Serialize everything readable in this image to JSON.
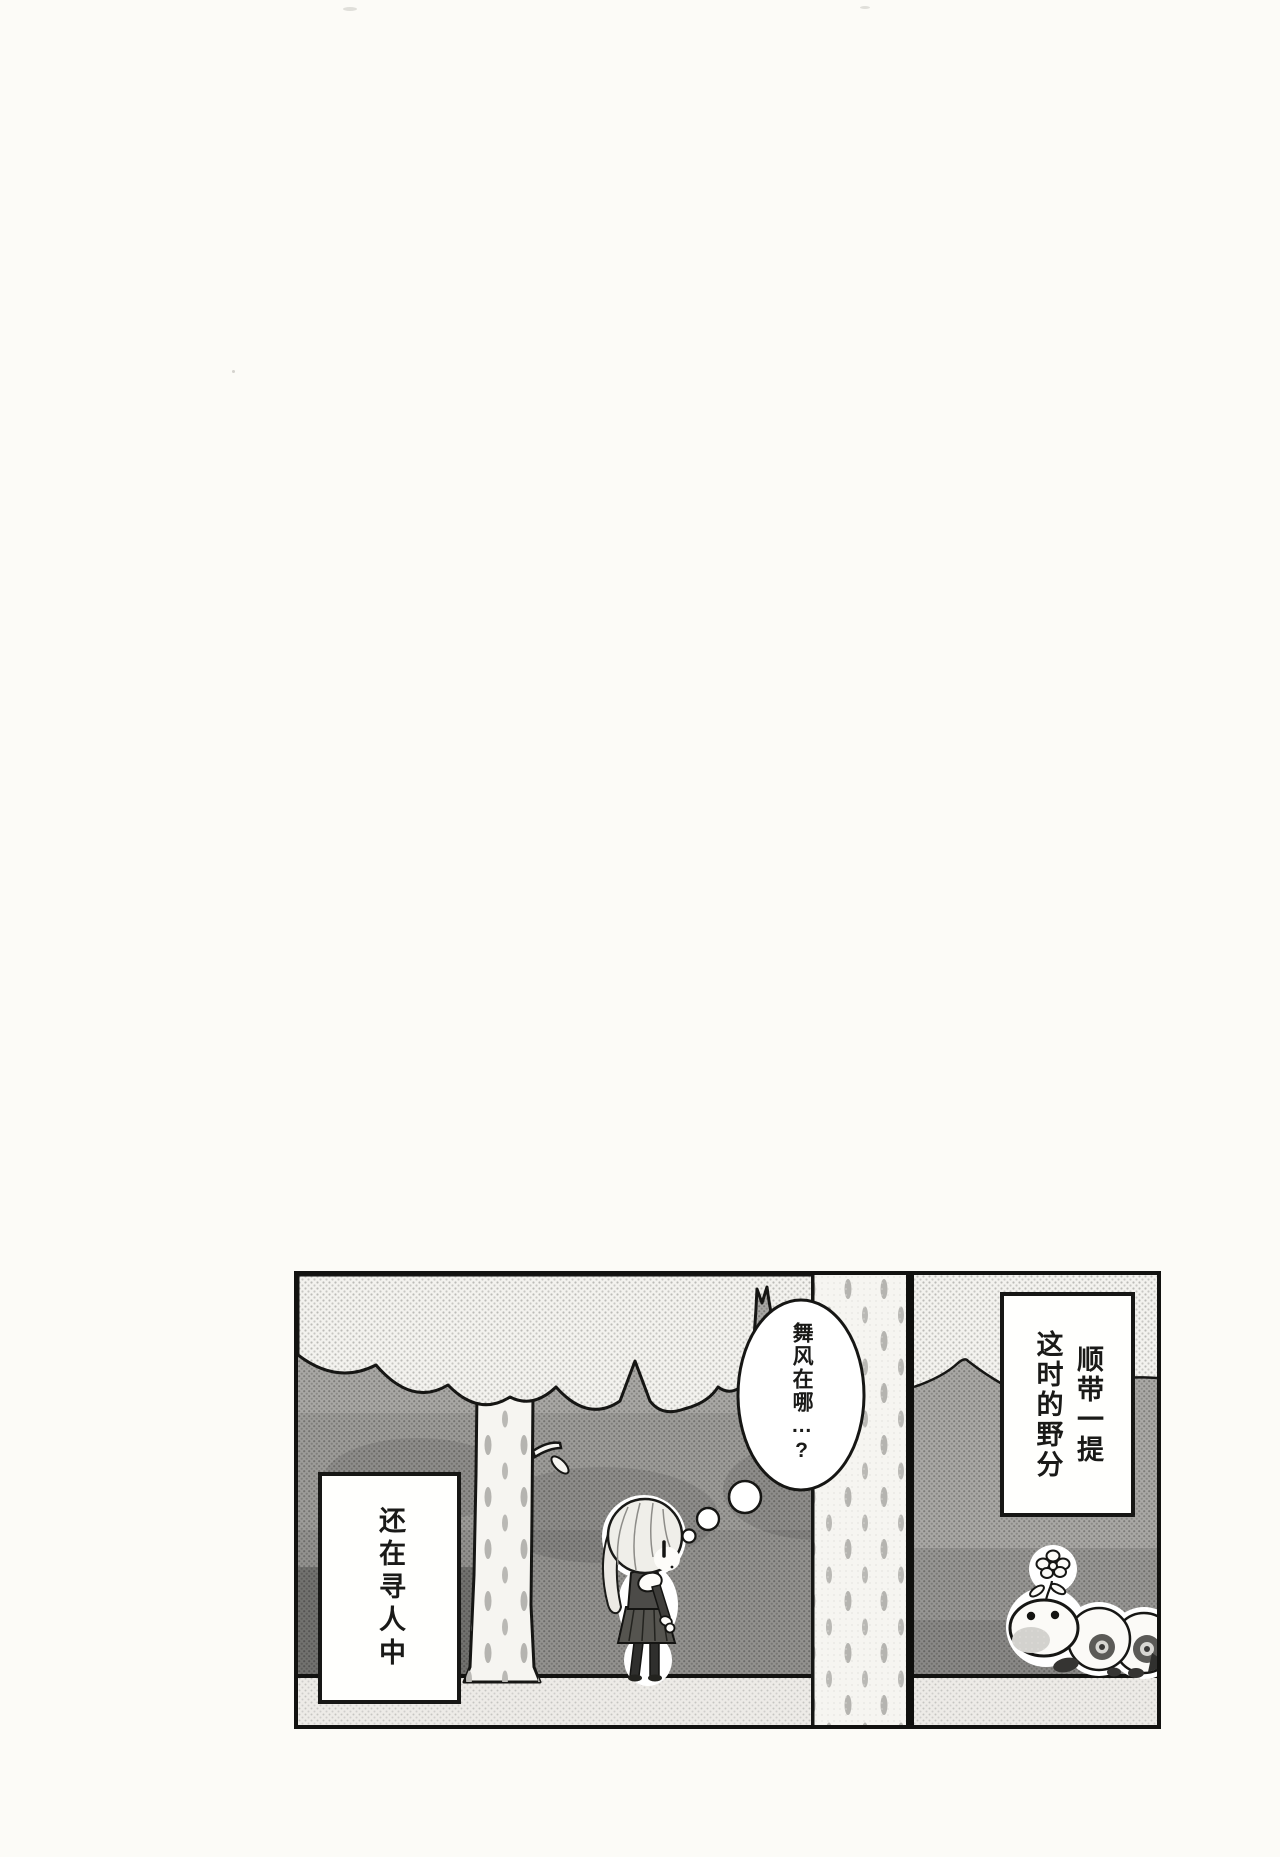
{
  "page": {
    "paper_color": "#fcfbf7",
    "ink_color": "#121210"
  },
  "panel": {
    "caption_right": "顺带一提\n这时的野分",
    "caption_left": "还在寻人中",
    "thought_bubble": "舞风在哪…?"
  }
}
